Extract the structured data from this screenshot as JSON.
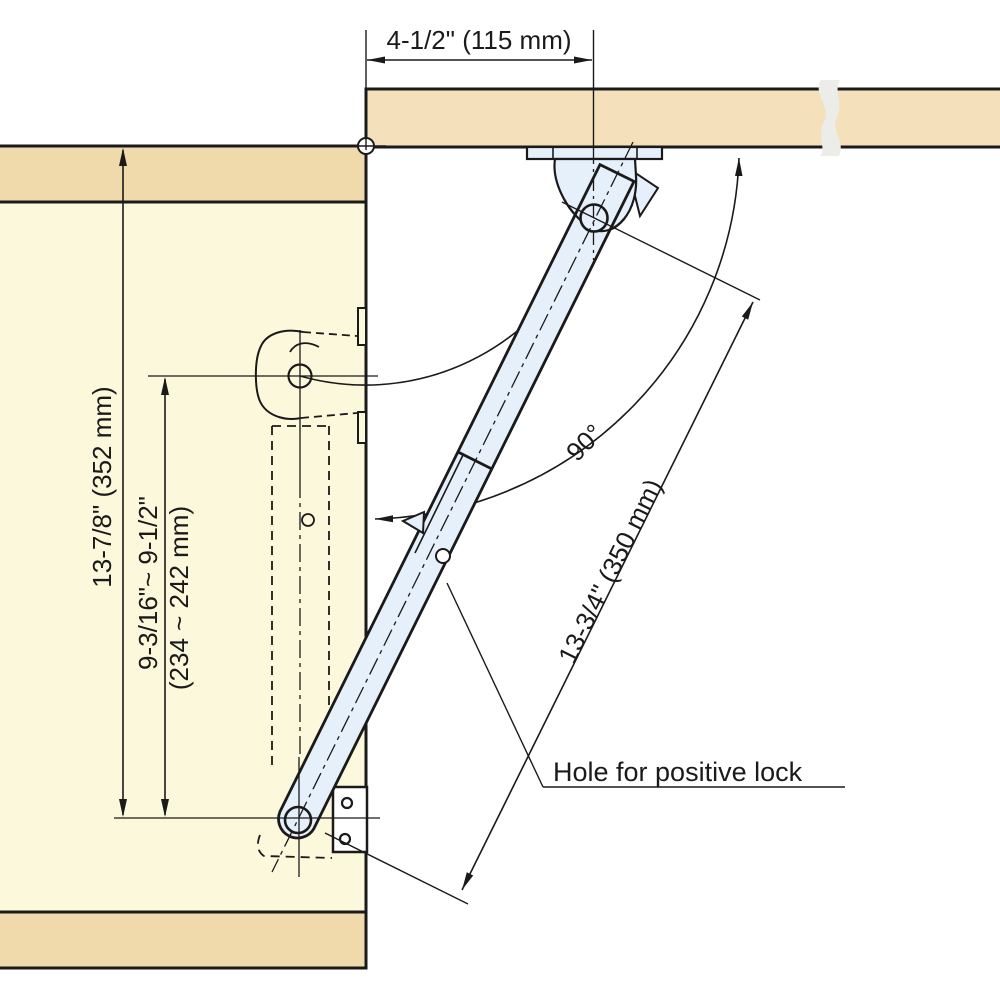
{
  "labels": {
    "dim_top": "4-1/2\" (115 mm)",
    "dim_height": "13-7/8\" (352 mm)",
    "dim_inner_inch": "9-3/16\"~ 9-1/2\"",
    "dim_inner_mm": "(234 ~ 242 mm)",
    "dim_arm": "13-3/4\" (350 mm)",
    "angle": "90°",
    "hole_note": "Hole for positive lock"
  },
  "colors": {
    "panel_tan": "#F2DEB4",
    "panel_face_yellow": "#FCF8DC",
    "stay_blue": "#E6F0FA",
    "line": "#1a1a1a",
    "break_gray": "#ECECE8"
  }
}
